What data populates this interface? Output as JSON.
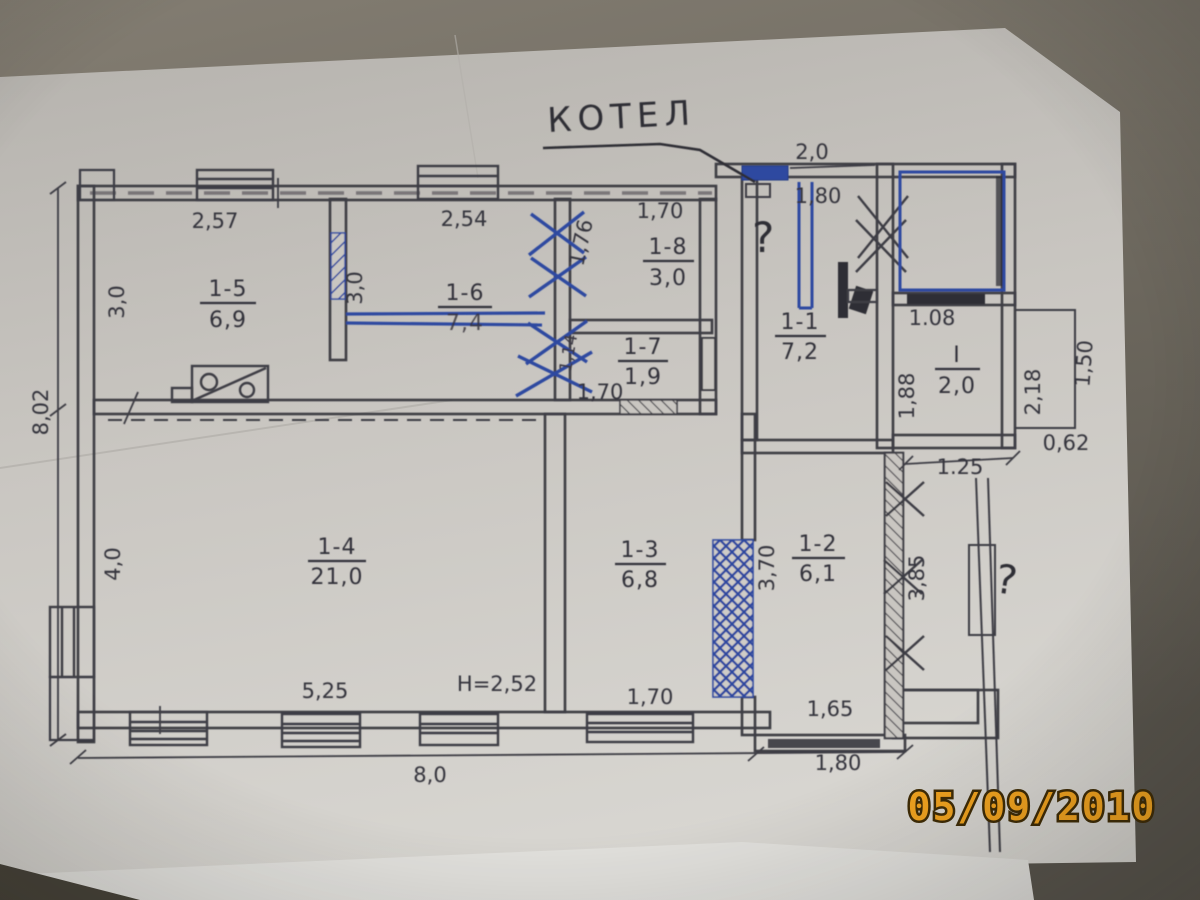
{
  "photo": {
    "date_stamp": "05/09/2010"
  },
  "handwriting": {
    "boiler": "КОТЕЛ",
    "question_top": "?",
    "question_right": "?"
  },
  "rooms": {
    "r15": {
      "num": "1-5",
      "area": "6,9"
    },
    "r16": {
      "num": "1-6",
      "area": "7,4"
    },
    "r18": {
      "num": "1-8",
      "area": "3,0"
    },
    "r17": {
      "num": "1-7",
      "area": "1,9"
    },
    "r11": {
      "num": "1-1",
      "area": "7,2"
    },
    "rI": {
      "num": "I",
      "area": "2,0"
    },
    "r14": {
      "num": "1-4",
      "area": "21,0"
    },
    "r13": {
      "num": "1-3",
      "area": "6,8"
    },
    "r12": {
      "num": "1-2",
      "area": "6,1"
    }
  },
  "dims": {
    "w_r15_top": "2,57",
    "h_r15_left": "3,0",
    "h_outer_left": "8,02",
    "w_r16_top": "2,54",
    "h_r16_right": "3,0",
    "h_r18_left": "1,76",
    "w_r18_top": "1,70",
    "h_mid_small": "1,14",
    "w_r17_bottom": "1,70",
    "w_top_right": "2,0",
    "w_boiler": "1,80",
    "w_rI_top": "1.08",
    "h_rI_left": "1,88",
    "h_porch": "2,18",
    "h_porch_right": "1,50",
    "w_porch_bottom": "0,62",
    "w_below_rI": "1.25",
    "h_fence": "3,85",
    "h_r12_left": "3,70",
    "w_r12_bottom": "1,65",
    "w_r13_bottom": "1,70",
    "w_r14_bottom": "5,25",
    "note_height": "H=2,52",
    "h_r14_left": "4,0",
    "w_bottom_main": "8,0",
    "w_bottom_right": "1,80"
  }
}
